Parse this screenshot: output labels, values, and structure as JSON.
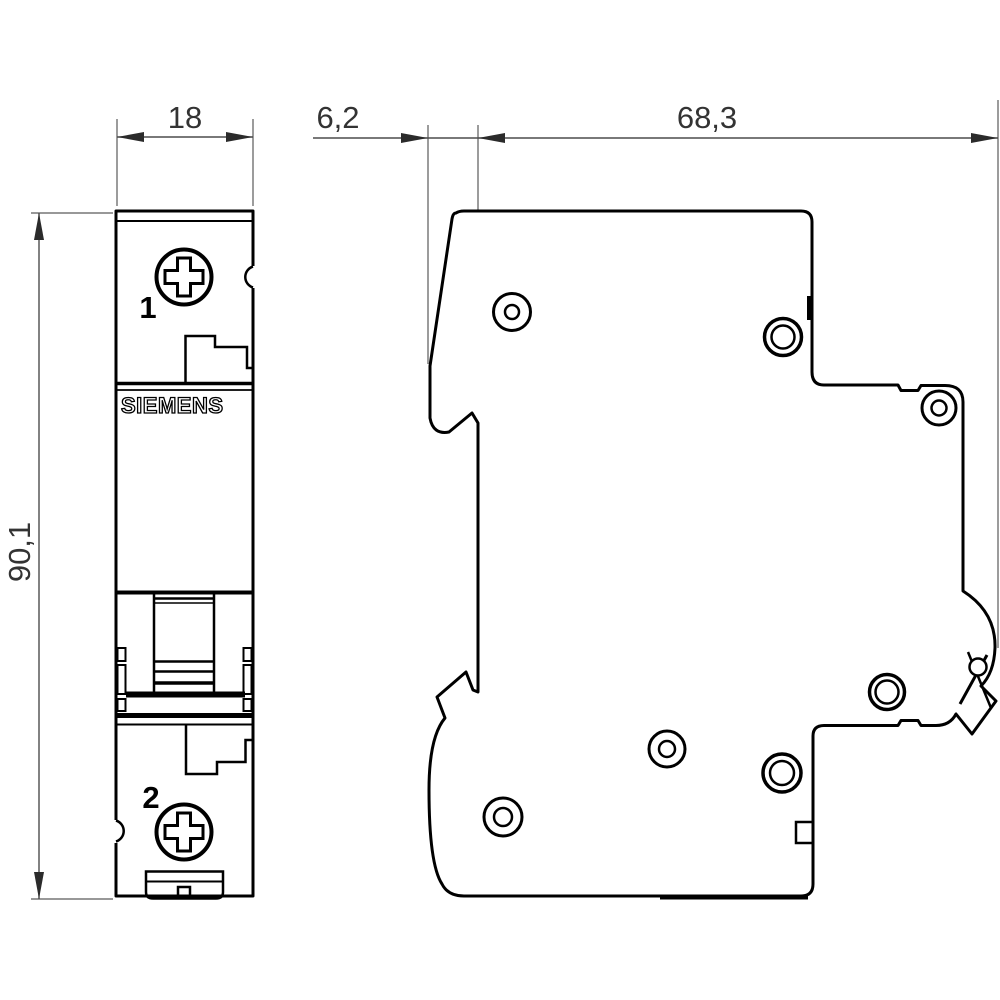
{
  "title": "Miniature circuit breaker dimensional drawing",
  "dims": {
    "front_width_mm": "18",
    "front_depth_offset_mm": "6,2",
    "body_depth_mm": "68,3",
    "body_height_mm": "90,1"
  },
  "front_view": {
    "brand": "SIEMENS",
    "terminal_top_label": "1",
    "terminal_bottom_label": "2"
  },
  "colors": {
    "outline": "#000000",
    "dimension_line": "#4d4d4d",
    "dimension_text": "#333333",
    "background": "#ffffff"
  }
}
